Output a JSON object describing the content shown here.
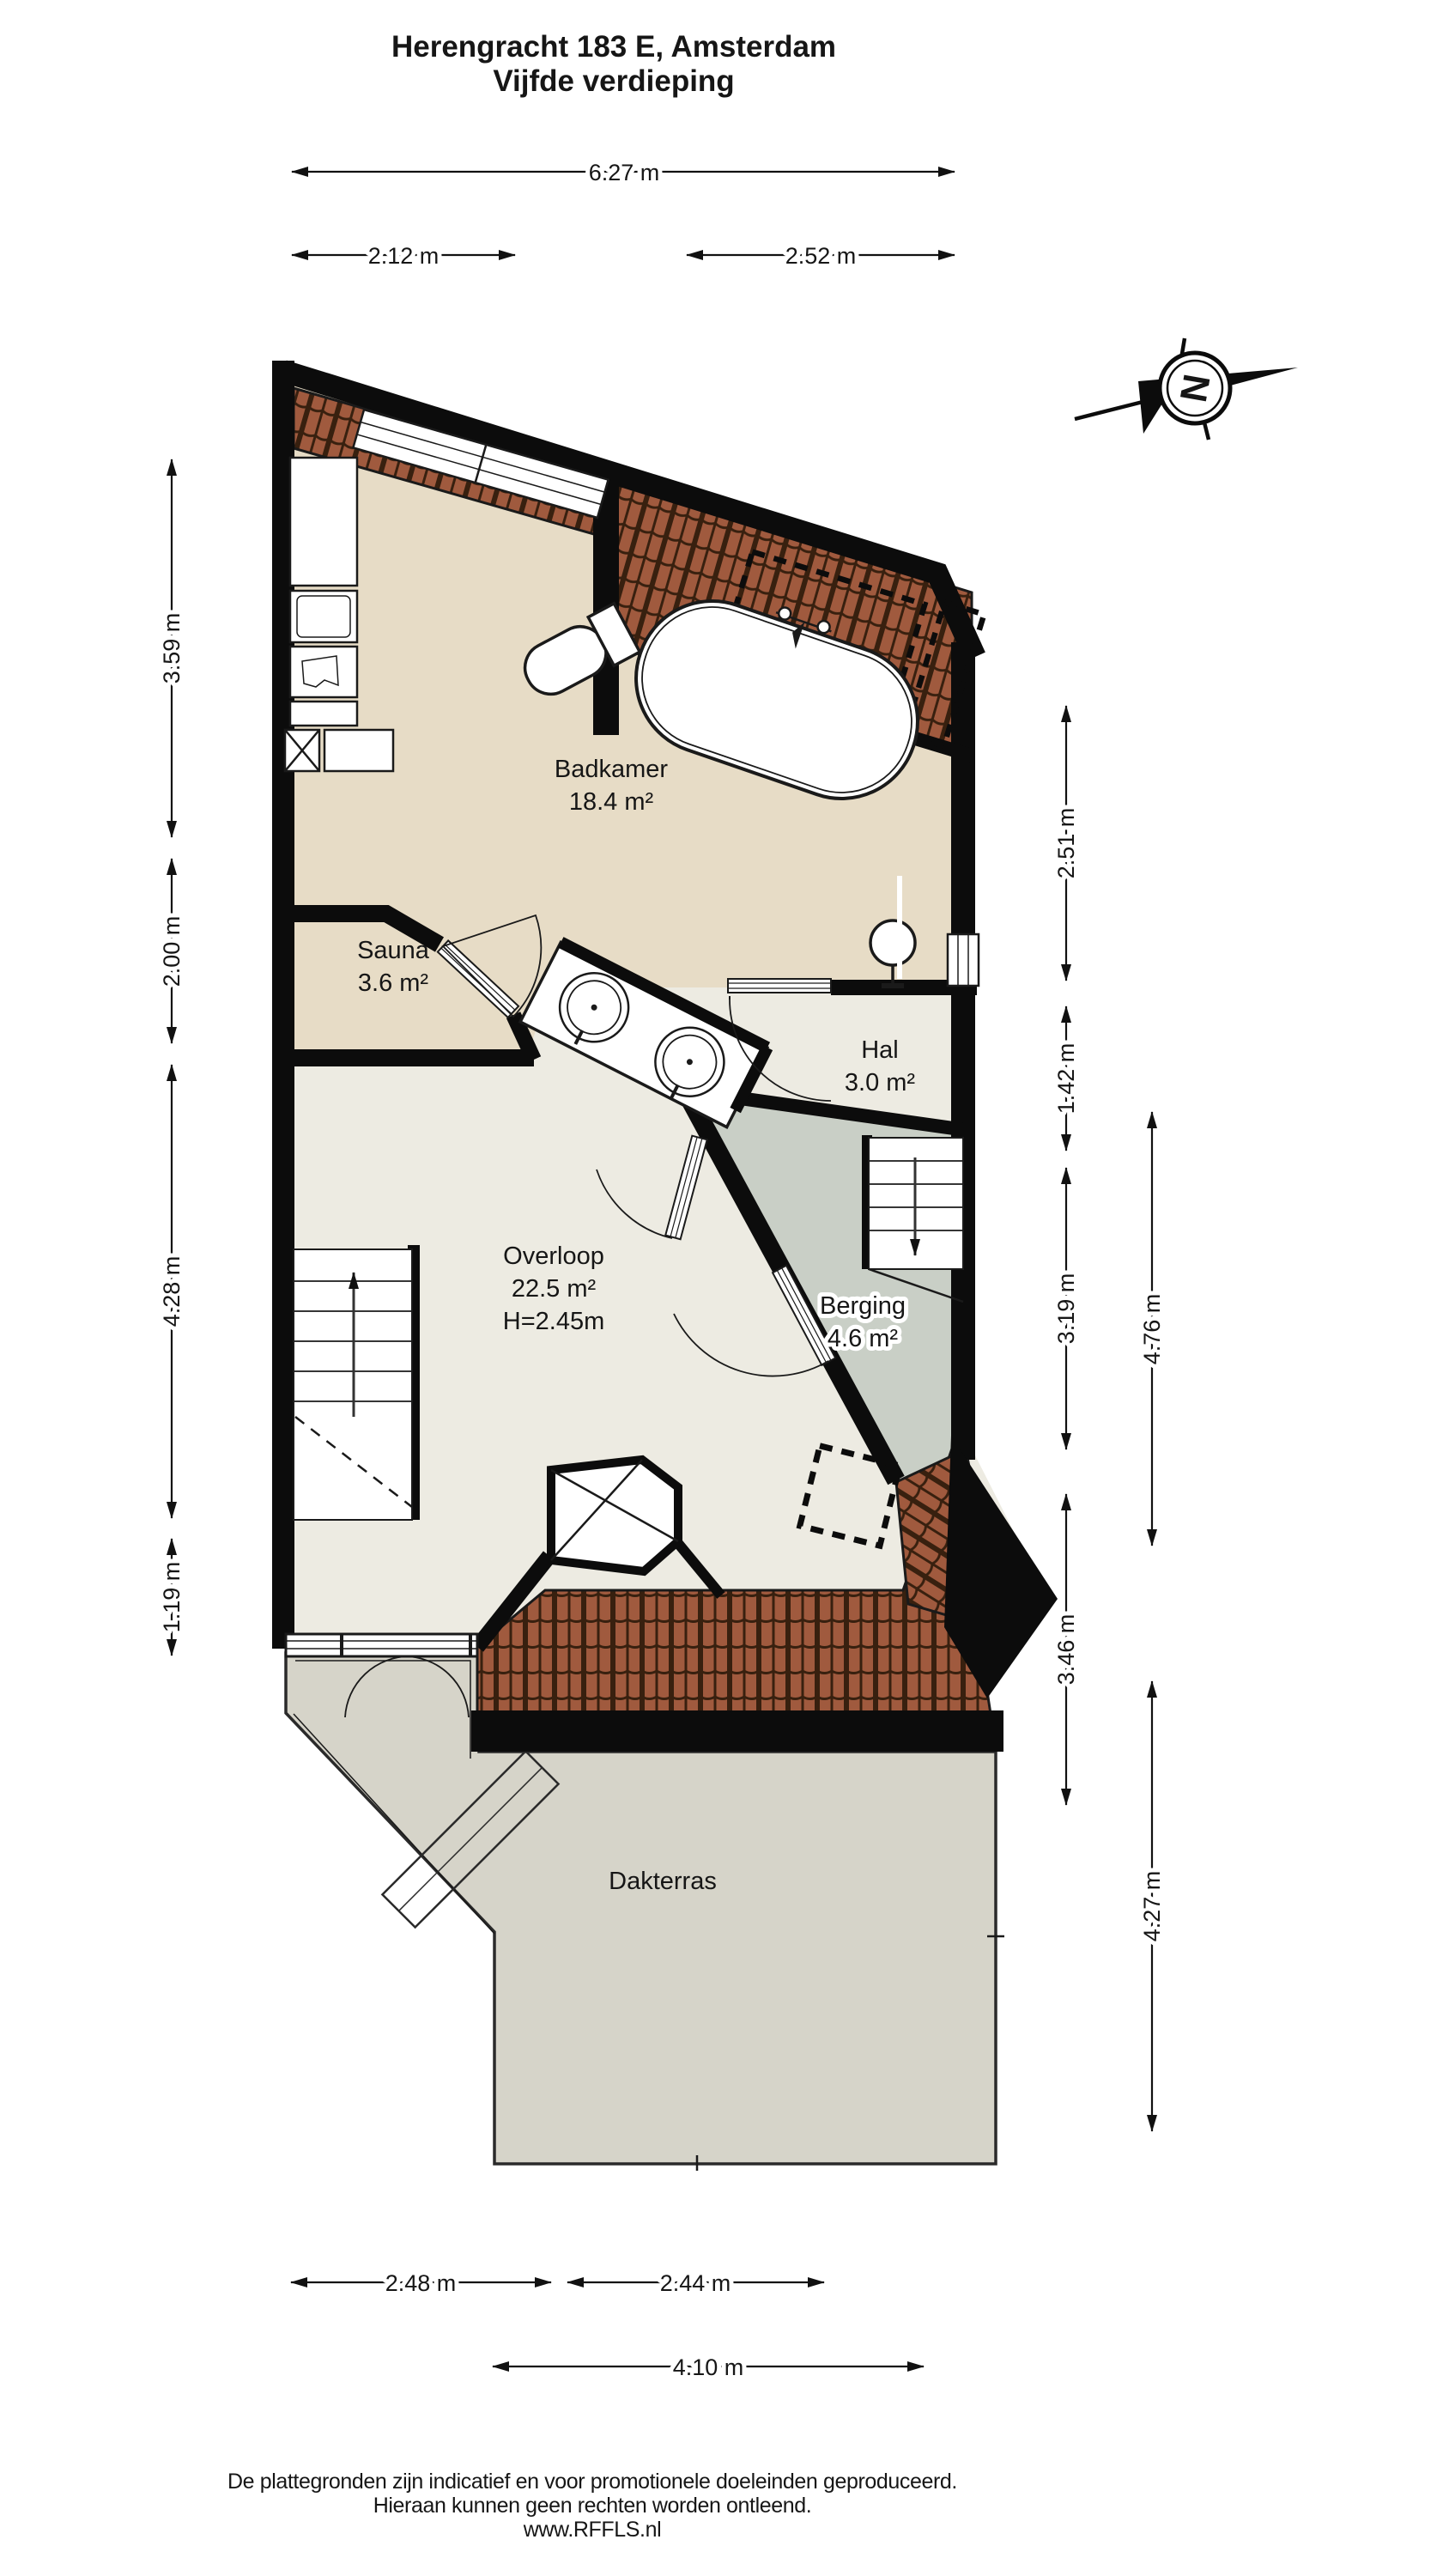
{
  "title": {
    "line1": "Herengracht 183 E, Amsterdam",
    "line2": "Vijfde verdieping"
  },
  "compass": {
    "letter": "N"
  },
  "rooms": {
    "badkamer": {
      "name": "Badkamer",
      "area": "18.4 m²"
    },
    "sauna": {
      "name": "Sauna",
      "area": "3.6 m²"
    },
    "hal": {
      "name": "Hal",
      "area": "3.0 m²"
    },
    "overloop": {
      "name": "Overloop",
      "area": "22.5 m²",
      "height": "H=2.45m"
    },
    "berging": {
      "name": "Berging",
      "area": "4.6 m²"
    },
    "dakterras": {
      "name": "Dakterras"
    }
  },
  "dimensions": {
    "top_total": "6.27 m",
    "top_left": "2.12 m",
    "top_right": "2.52 m",
    "left_1": "3.59 m",
    "left_2": "2.00 m",
    "left_3": "4.28 m",
    "left_4": "1.19 m",
    "right_1": "2.51 m",
    "right_2": "1.42 m",
    "right_3": "3.19 m",
    "right_4": "3.46 m",
    "right_outer_1": "4.76 m",
    "right_outer_2": "4.27 m",
    "bottom_left": "2.48 m",
    "bottom_right": "2.44 m",
    "bottom_total": "4.10 m"
  },
  "footer": {
    "line1": "De plattegronden zijn indicatief en voor promotionele doeleinden geproduceerd.",
    "line2": "Hieraan kunnen geen rechten worden ontleend.",
    "line3": "www.RFFLS.nl"
  },
  "colors": {
    "wall": "#0c0c0c",
    "badkamer_floor": "#e7dcc6",
    "overloop_floor": "#edebe2",
    "berging_floor": "#c9cfc6",
    "terras_floor": "#d6d4c9",
    "roof_tile": "#a05a3e",
    "roof_tile_line": "#38200f"
  }
}
